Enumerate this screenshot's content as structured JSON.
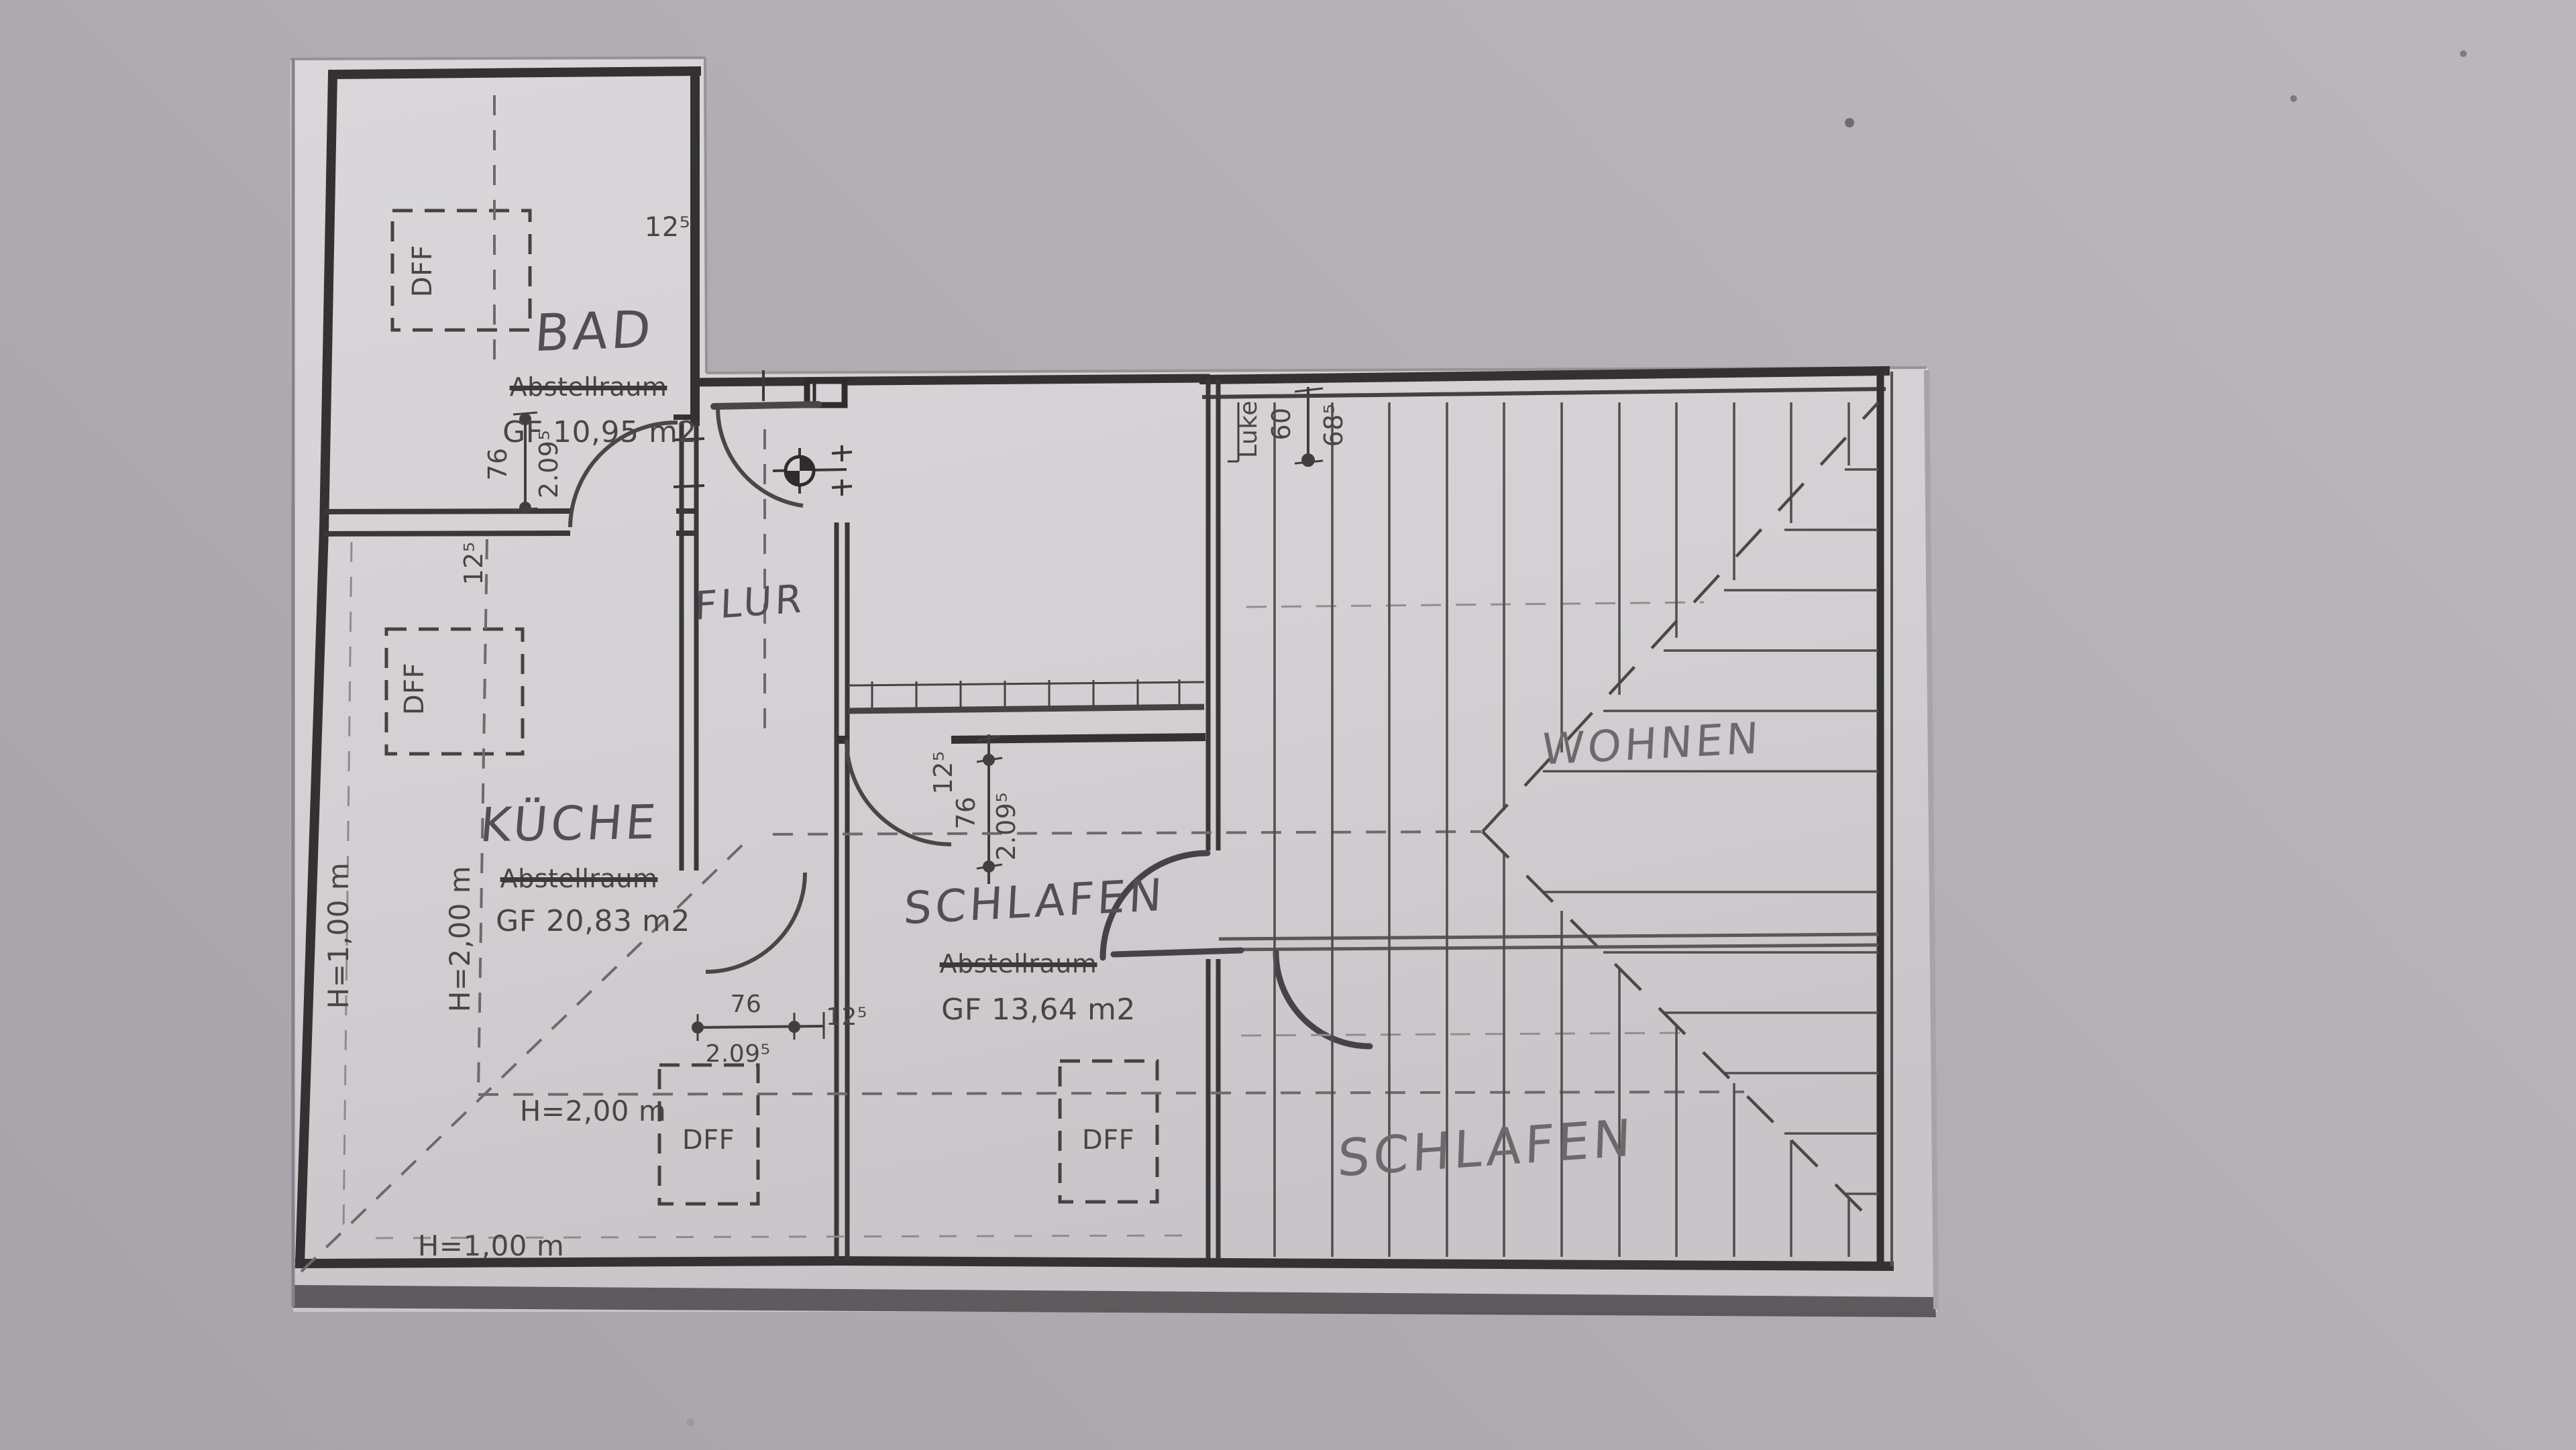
{
  "rooms": {
    "bad": {
      "name": "BAD",
      "struck_label": "Abstellraum",
      "area": "GF 10,95 m2"
    },
    "kueche": {
      "name": "KÜCHE",
      "struck_label": "Abstellraum",
      "area": "GF 20,83 m2"
    },
    "flur": {
      "name": "FLUR"
    },
    "schlafen_mitte": {
      "name": "SCHLAFEN",
      "struck_label": "Abstellraum",
      "area": "GF 13,64 m2"
    },
    "wohnen": {
      "name": "WOHNEN"
    },
    "schlafen_rechts": {
      "name": "SCHLAFEN"
    }
  },
  "skylight_label": "DFF",
  "hatch": {
    "label": "Luke",
    "width": "60",
    "offset": "68⁵"
  },
  "heights": {
    "h100": "H=1,00 m",
    "h200": "H=2,00 m"
  },
  "dims": {
    "wall_thickness": "12⁵",
    "door_width": "76",
    "door_height": "2.09⁵"
  }
}
